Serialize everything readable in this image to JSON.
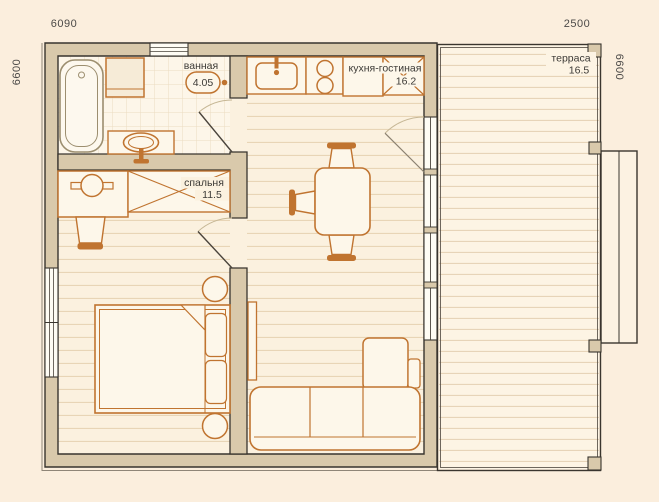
{
  "plan": {
    "type": "floor-plan",
    "language": "ru"
  },
  "dimensions": {
    "width_main": "6090",
    "width_terrace": "2500",
    "height_left": "6600",
    "height_right": "6600"
  },
  "rooms": {
    "bathroom": {
      "label": "ванная",
      "area": "4.05"
    },
    "bedroom": {
      "label": "спальня",
      "area": "11.5"
    },
    "kitchen_living": {
      "label": "кухня-гостиная",
      "area": "16.2"
    },
    "terrace": {
      "label": "терраса",
      "area": "16.5"
    }
  },
  "colors": {
    "background": "#fbeedd",
    "wall_fill": "#d9c9ab",
    "wall_stroke": "#38342e",
    "furniture_stroke": "#c07430",
    "furniture_fill": "#fdf7ea",
    "floor": "#fbf1df",
    "floor_line": "#e8d5b6",
    "label_text": "#3c3a36",
    "dimension_text": "#4b4947"
  },
  "furniture": {
    "bathroom": [
      "bathtub",
      "washing-machine",
      "toilet",
      "sink-vanity"
    ],
    "bedroom": [
      "desk",
      "desk-chair",
      "wardrobe",
      "double-bed",
      "nightstand-top",
      "nightstand-bottom"
    ],
    "kitchen_living": [
      "kitchen-sink-counter",
      "cooktop",
      "counter",
      "wardrobe",
      "dining-table",
      "dining-chair-top",
      "dining-chair-left",
      "dining-chair-bottom",
      "tv-panel",
      "corner-sofa"
    ],
    "terrace": [
      "entry-steps"
    ]
  }
}
